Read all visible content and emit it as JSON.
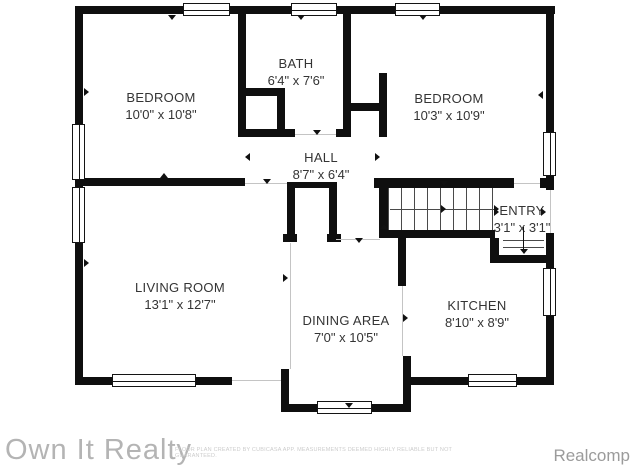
{
  "plan": {
    "rooms": [
      {
        "name": "BEDROOM",
        "dimensions": "10'0\" x 10'8\""
      },
      {
        "name": "BATH",
        "dimensions": "6'4\" x 7'6\""
      },
      {
        "name": "BEDROOM",
        "dimensions": "10'3\" x 10'9\""
      },
      {
        "name": "HALL",
        "dimensions": "8'7\" x 6'4\""
      },
      {
        "name": "ENTRY",
        "dimensions": "3'1\" x 3'1\""
      },
      {
        "name": "LIVING ROOM",
        "dimensions": "13'1\" x 12'7\""
      },
      {
        "name": "DINING AREA",
        "dimensions": "7'0\" x 10'5\""
      },
      {
        "name": "KITCHEN",
        "dimensions": "8'10\" x 8'9\""
      }
    ]
  },
  "footer": {
    "brand": "Own It Realty",
    "disclaimer": "FLOOR PLAN CREATED BY CUBICASA APP. MEASUREMENTS DEEMED HIGHLY RELIABLE BUT NOT GUARANTEED.",
    "attribution": "Realcomp"
  },
  "colors": {
    "wall": "#0f0f0f",
    "label_text": "#343434",
    "watermark": "#b4b4b4",
    "attribution_text": "#9b9b9b"
  }
}
